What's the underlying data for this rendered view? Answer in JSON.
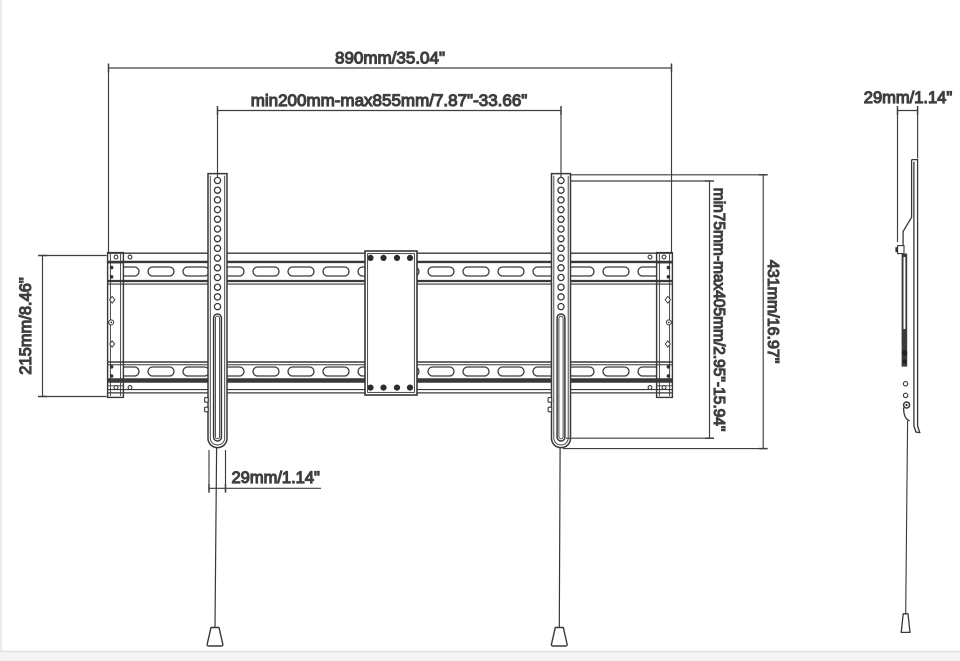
{
  "diagram": {
    "type": "technical-drawing",
    "subject": "TV wall mount bracket - front view and side view with dimension callouts",
    "colors": {
      "line": "#383838",
      "dimension_line": "#3f3f3f",
      "text": "#3a3a3a",
      "background": "#ffffff",
      "page_edge": "#f3f4f6"
    },
    "dimensions": {
      "total_width": "890mm/35.04\"",
      "rail_span": "min200mm-max855mm/7.87\"-33.66\"",
      "plate_height": "215mm/8.46\"",
      "arm_width": "29mm/1.14\"",
      "vesa_vertical_range": "min75mm-max405mm/2.95\"-15.94\"",
      "arm_height": "431mm/16.97\"",
      "side_depth": "29mm/1.14\""
    }
  }
}
